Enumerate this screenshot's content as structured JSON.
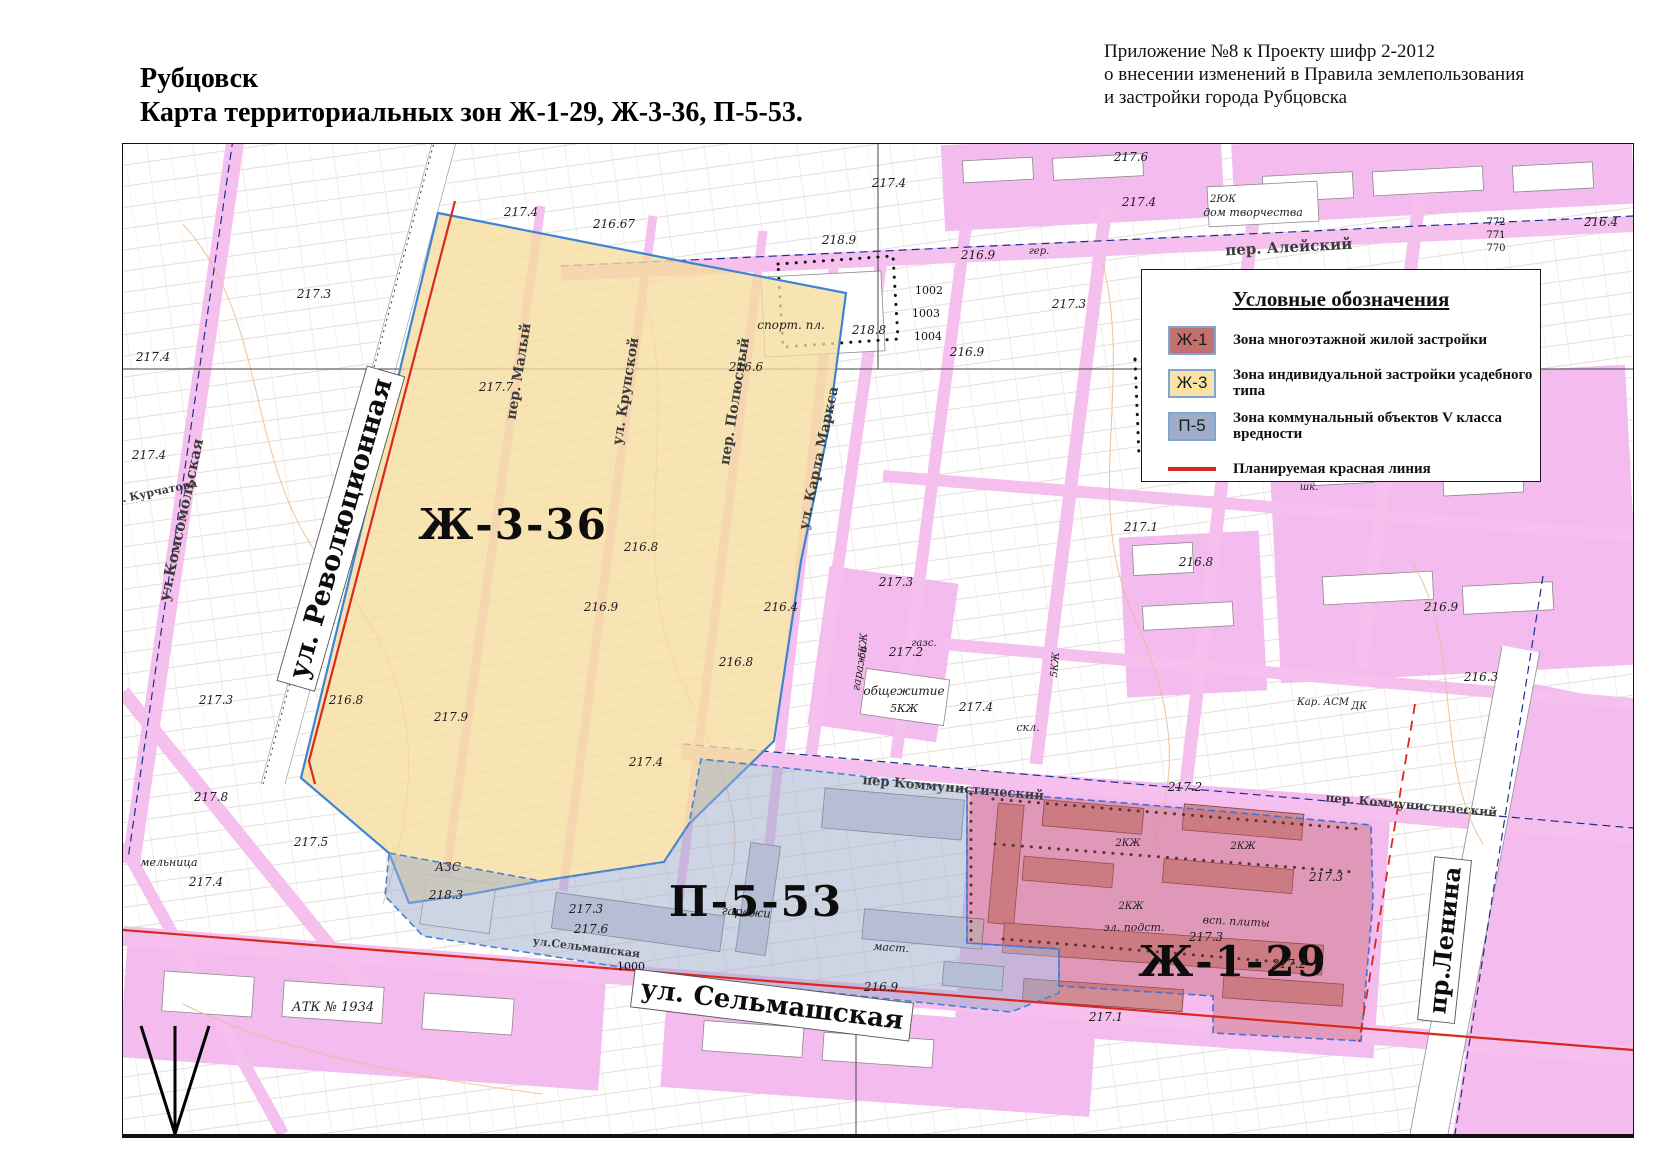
{
  "header": {
    "annotation_lines": [
      "Приложение №8 к Проекту шифр 2-2012",
      "о внесении изменений в Правила землепользования",
      "и застройки города Рубцовска"
    ],
    "title_line1": "Рубцовск",
    "title_line2": "Карта территориальных зон Ж-1-29, Ж-3-36, П-5-53."
  },
  "legend": {
    "title": "Условные обозначения",
    "items": [
      {
        "code": "Ж-1",
        "color": "#c1706d",
        "label": "Зона многоэтажной жилой застройки"
      },
      {
        "code": "Ж-3",
        "color": "#f8e3a4",
        "label": "Зона индивидуальной застройки усадебного типа"
      },
      {
        "code": "П-5",
        "color": "#9fadc9",
        "label": "Зона коммунальный объектов V класса вредности"
      }
    ],
    "red_line": {
      "color": "#d9291d",
      "label": "Планируемая красная линия"
    }
  },
  "map": {
    "zones": [
      {
        "id": "zh336",
        "name": "Ж-3-36",
        "fill": "#f6dc9c",
        "opacity": 0.78,
        "stroke": "#3c85d6"
      },
      {
        "id": "p553",
        "name": "П-5-53",
        "fill": "#9fadc9",
        "opacity": 0.52,
        "stroke": "#4a82cf"
      },
      {
        "id": "zh129",
        "name": "Ж-1-29",
        "fill": "#c4646a",
        "opacity": 0.4,
        "stroke": "#4a6fd4"
      }
    ],
    "labels": [
      {
        "t": "Ж-3-36",
        "x": 390,
        "y": 395,
        "s": 42,
        "r": 0,
        "k": "zone"
      },
      {
        "t": "П-5-53",
        "x": 633,
        "y": 772,
        "s": 42,
        "r": 0,
        "k": "zone"
      },
      {
        "t": "Ж-1-29",
        "x": 1110,
        "y": 832,
        "s": 42,
        "r": 0,
        "k": "zone"
      },
      {
        "t": "ул. Революционная",
        "x": 226,
        "y": 387,
        "s": 27,
        "r": -74,
        "k": "big"
      },
      {
        "t": "ул. Сельмашская",
        "x": 648,
        "y": 869,
        "s": 26,
        "r": 7,
        "k": "big"
      },
      {
        "t": "пр.Ленина",
        "x": 1330,
        "y": 797,
        "s": 24,
        "r": -84,
        "k": "big"
      },
      {
        "t": "ул.Комсомольская",
        "x": 63,
        "y": 377,
        "s": 15,
        "r": -78,
        "k": "st"
      },
      {
        "t": "пер. Алейский",
        "x": 1166,
        "y": 108,
        "s": 15,
        "r": -3,
        "k": "st"
      },
      {
        "t": "пер Коммунистический",
        "x": 830,
        "y": 648,
        "s": 13,
        "r": 5,
        "k": "st"
      },
      {
        "t": "пер. Коммунистический",
        "x": 1288,
        "y": 665,
        "s": 12,
        "r": 5,
        "k": "st"
      },
      {
        "t": "пер. Малый",
        "x": 400,
        "y": 228,
        "s": 14,
        "r": -81,
        "k": "st"
      },
      {
        "t": "ул. Крупской",
        "x": 507,
        "y": 248,
        "s": 14,
        "r": -81,
        "k": "st"
      },
      {
        "t": "пер. Полюсный",
        "x": 616,
        "y": 258,
        "s": 14,
        "r": -81,
        "k": "st"
      },
      {
        "t": "ул. Карла Маркса",
        "x": 700,
        "y": 315,
        "s": 14,
        "r": -78,
        "k": "st"
      },
      {
        "t": "ул. Курчатова",
        "x": 30,
        "y": 352,
        "s": 11,
        "r": -12,
        "k": "st"
      },
      {
        "t": "ул.Сельмашская",
        "x": 463,
        "y": 807,
        "s": 11,
        "r": 7,
        "k": "st"
      },
      {
        "t": "спорт. пл.",
        "x": 668,
        "y": 185,
        "s": 12,
        "r": 0,
        "k": "bld"
      },
      {
        "t": "дом творчества",
        "x": 1130,
        "y": 72,
        "s": 11,
        "r": 0,
        "k": "bld"
      },
      {
        "t": "2ЮК",
        "x": 1100,
        "y": 58,
        "s": 10,
        "r": 0,
        "k": "bld"
      },
      {
        "t": "общежитие",
        "x": 781,
        "y": 551,
        "s": 12,
        "r": 0,
        "k": "bld"
      },
      {
        "t": "5КЖ",
        "x": 781,
        "y": 568,
        "s": 11,
        "r": 0,
        "k": "bld"
      },
      {
        "t": "АЗС",
        "x": 325,
        "y": 727,
        "s": 12,
        "r": 0,
        "k": "bld"
      },
      {
        "t": "гаражи",
        "x": 740,
        "y": 525,
        "s": 11,
        "r": -80,
        "k": "bld"
      },
      {
        "t": "гаражи",
        "x": 623,
        "y": 772,
        "s": 12,
        "r": 4,
        "k": "bld"
      },
      {
        "t": "маст.",
        "x": 768,
        "y": 807,
        "s": 11,
        "r": 4,
        "k": "bld"
      },
      {
        "t": "скл.",
        "x": 905,
        "y": 587,
        "s": 11,
        "r": 0,
        "k": "bld"
      },
      {
        "t": "эл. подст.",
        "x": 1011,
        "y": 787,
        "s": 11,
        "r": 0,
        "k": "bld"
      },
      {
        "t": "всп. плиты",
        "x": 1113,
        "y": 781,
        "s": 11,
        "r": 3,
        "k": "bld"
      },
      {
        "t": "АТК № 1934",
        "x": 210,
        "y": 867,
        "s": 13,
        "r": 0,
        "k": "bld"
      },
      {
        "t": "мельница",
        "x": 46,
        "y": 722,
        "s": 11,
        "r": 0,
        "k": "bld"
      },
      {
        "t": "газс.",
        "x": 801,
        "y": 502,
        "s": 10,
        "r": 0,
        "k": "bld"
      },
      {
        "t": "гер.",
        "x": 916,
        "y": 110,
        "s": 10,
        "r": 0,
        "k": "bld"
      },
      {
        "t": "Кар. АСМ",
        "x": 1200,
        "y": 561,
        "s": 10,
        "r": 0,
        "k": "bld"
      },
      {
        "t": "ДК",
        "x": 1236,
        "y": 565,
        "s": 10,
        "r": 0,
        "k": "bld"
      },
      {
        "t": "шк.",
        "x": 1186,
        "y": 346,
        "s": 10,
        "r": 0,
        "k": "bld"
      },
      {
        "t": "2КЖ",
        "x": 1005,
        "y": 702,
        "s": 10,
        "r": 0,
        "k": "bld"
      },
      {
        "t": "2КЖ",
        "x": 1120,
        "y": 705,
        "s": 10,
        "r": 0,
        "k": "bld"
      },
      {
        "t": "2КЖ",
        "x": 1008,
        "y": 765,
        "s": 10,
        "r": 0,
        "k": "bld"
      },
      {
        "t": "5КЖ",
        "x": 743,
        "y": 502,
        "s": 10,
        "r": -85,
        "k": "bld"
      },
      {
        "t": "5КЖ",
        "x": 935,
        "y": 521,
        "s": 10,
        "r": -85,
        "k": "bld"
      },
      {
        "t": "1002",
        "x": 806,
        "y": 150,
        "s": 11,
        "r": 0,
        "k": "num"
      },
      {
        "t": "1003",
        "x": 803,
        "y": 173,
        "s": 11,
        "r": 0,
        "k": "num"
      },
      {
        "t": "1004",
        "x": 805,
        "y": 196,
        "s": 11,
        "r": 0,
        "k": "num"
      },
      {
        "t": "1000",
        "x": 508,
        "y": 826,
        "s": 11,
        "r": 0,
        "k": "num"
      },
      {
        "t": "772",
        "x": 1373,
        "y": 81,
        "s": 10,
        "r": 0,
        "k": "num"
      },
      {
        "t": "771",
        "x": 1373,
        "y": 94,
        "s": 10,
        "r": 0,
        "k": "num"
      },
      {
        "t": "770",
        "x": 1373,
        "y": 107,
        "s": 10,
        "r": 0,
        "k": "num"
      },
      {
        "t": "217.6",
        "x": 1008,
        "y": 17,
        "s": 12,
        "r": 0,
        "k": "elev"
      },
      {
        "t": "217.4",
        "x": 766,
        "y": 43,
        "s": 12,
        "r": 0,
        "k": "elev"
      },
      {
        "t": "217.4",
        "x": 1016,
        "y": 62,
        "s": 12,
        "r": 0,
        "k": "elev"
      },
      {
        "t": "216.67",
        "x": 491,
        "y": 84,
        "s": 12,
        "r": 0,
        "k": "elev"
      },
      {
        "t": "217.4",
        "x": 398,
        "y": 72,
        "s": 12,
        "r": 0,
        "k": "elev"
      },
      {
        "t": "218.9",
        "x": 716,
        "y": 100,
        "s": 12,
        "r": 0,
        "k": "elev"
      },
      {
        "t": "216.9",
        "x": 855,
        "y": 115,
        "s": 12,
        "r": 0,
        "k": "elev"
      },
      {
        "t": "217.3",
        "x": 946,
        "y": 164,
        "s": 12,
        "r": 0,
        "k": "elev"
      },
      {
        "t": "218.8",
        "x": 746,
        "y": 190,
        "s": 12,
        "r": 0,
        "k": "elev"
      },
      {
        "t": "216.9",
        "x": 844,
        "y": 212,
        "s": 12,
        "r": 0,
        "k": "elev"
      },
      {
        "t": "216.4",
        "x": 1478,
        "y": 82,
        "s": 12,
        "r": 0,
        "k": "elev"
      },
      {
        "t": "217.3",
        "x": 191,
        "y": 154,
        "s": 12,
        "r": 0,
        "k": "elev"
      },
      {
        "t": "217.4",
        "x": 30,
        "y": 217,
        "s": 12,
        "r": 0,
        "k": "elev"
      },
      {
        "t": "217.7",
        "x": 373,
        "y": 247,
        "s": 12,
        "r": 0,
        "k": "elev"
      },
      {
        "t": "217.4",
        "x": 26,
        "y": 315,
        "s": 12,
        "r": 0,
        "k": "elev"
      },
      {
        "t": "216.6",
        "x": 623,
        "y": 227,
        "s": 12,
        "r": 0,
        "k": "elev"
      },
      {
        "t": "216.8",
        "x": 518,
        "y": 407,
        "s": 12,
        "r": 0,
        "k": "elev"
      },
      {
        "t": "216.9",
        "x": 478,
        "y": 467,
        "s": 12,
        "r": 0,
        "k": "elev"
      },
      {
        "t": "216.4",
        "x": 658,
        "y": 467,
        "s": 12,
        "r": 0,
        "k": "elev"
      },
      {
        "t": "216.8",
        "x": 613,
        "y": 522,
        "s": 12,
        "r": 0,
        "k": "elev"
      },
      {
        "t": "217.3",
        "x": 93,
        "y": 560,
        "s": 12,
        "r": 0,
        "k": "elev"
      },
      {
        "t": "216.8",
        "x": 223,
        "y": 560,
        "s": 12,
        "r": 0,
        "k": "elev"
      },
      {
        "t": "217.8",
        "x": 88,
        "y": 657,
        "s": 12,
        "r": 0,
        "k": "elev"
      },
      {
        "t": "217.5",
        "x": 188,
        "y": 702,
        "s": 12,
        "r": 0,
        "k": "elev"
      },
      {
        "t": "217.9",
        "x": 328,
        "y": 577,
        "s": 12,
        "r": 0,
        "k": "elev"
      },
      {
        "t": "217.4",
        "x": 523,
        "y": 622,
        "s": 12,
        "r": 0,
        "k": "elev"
      },
      {
        "t": "217.4",
        "x": 83,
        "y": 742,
        "s": 12,
        "r": 0,
        "k": "elev"
      },
      {
        "t": "218.3",
        "x": 323,
        "y": 755,
        "s": 12,
        "r": 0,
        "k": "elev"
      },
      {
        "t": "217.3",
        "x": 463,
        "y": 769,
        "s": 12,
        "r": 0,
        "k": "elev"
      },
      {
        "t": "217.2",
        "x": 783,
        "y": 512,
        "s": 12,
        "r": 0,
        "k": "elev"
      },
      {
        "t": "217.3",
        "x": 773,
        "y": 442,
        "s": 12,
        "r": 0,
        "k": "elev"
      },
      {
        "t": "217.4",
        "x": 853,
        "y": 567,
        "s": 12,
        "r": 0,
        "k": "elev"
      },
      {
        "t": "217.1",
        "x": 1018,
        "y": 387,
        "s": 12,
        "r": 0,
        "k": "elev"
      },
      {
        "t": "216.8",
        "x": 1073,
        "y": 422,
        "s": 12,
        "r": 0,
        "k": "elev"
      },
      {
        "t": "217.2",
        "x": 1062,
        "y": 647,
        "s": 12,
        "r": 0,
        "k": "elev"
      },
      {
        "t": "217.3",
        "x": 1203,
        "y": 737,
        "s": 12,
        "r": 0,
        "k": "elev"
      },
      {
        "t": "217.3",
        "x": 1083,
        "y": 797,
        "s": 12,
        "r": 0,
        "k": "elev"
      },
      {
        "t": "217.2",
        "x": 1166,
        "y": 824,
        "s": 12,
        "r": 0,
        "k": "elev"
      },
      {
        "t": "216.9",
        "x": 758,
        "y": 847,
        "s": 12,
        "r": 0,
        "k": "elev"
      },
      {
        "t": "217.1",
        "x": 983,
        "y": 877,
        "s": 12,
        "r": 0,
        "k": "elev"
      },
      {
        "t": "216.9",
        "x": 1318,
        "y": 467,
        "s": 12,
        "r": 0,
        "k": "elev"
      },
      {
        "t": "216.3",
        "x": 1358,
        "y": 537,
        "s": 12,
        "r": 0,
        "k": "elev"
      },
      {
        "t": "217.6",
        "x": 468,
        "y": 789,
        "s": 12,
        "r": 0,
        "k": "elev"
      }
    ]
  }
}
